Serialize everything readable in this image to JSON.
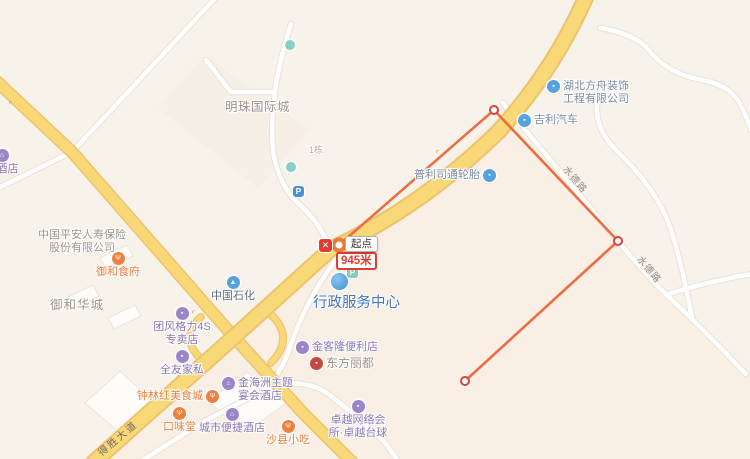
{
  "map": {
    "measurement": {
      "start_label": "起点",
      "distance": "945米",
      "delete_icon": "✕"
    },
    "road_labels": [
      {
        "name": "desheng-avenue",
        "label": "得胜大道"
      },
      {
        "name": "shuide-road-upper",
        "label": "水德路"
      },
      {
        "name": "shuide-road-lower",
        "label": "水德路"
      }
    ],
    "pois": [
      {
        "name": "hotel-left-edge",
        "lines": [
          "大酒店"
        ],
        "glyph": "⌂"
      },
      {
        "name": "mingzhu-international",
        "lines": [
          "明珠国际城"
        ]
      },
      {
        "name": "building-number",
        "lines": [
          "1栋"
        ]
      },
      {
        "name": "hubei-fangzhou-decor",
        "lines": [
          "湖北方舟装饰",
          "工程有限公司"
        ],
        "glyph": "▪"
      },
      {
        "name": "geely-auto",
        "lines": [
          "吉利汽车"
        ],
        "glyph": "▪"
      },
      {
        "name": "bridgestone-tires",
        "lines": [
          "普利司通轮胎"
        ],
        "glyph": "▪"
      },
      {
        "name": "sinopec",
        "lines": [
          "中国石化"
        ],
        "glyph": "▲"
      },
      {
        "name": "pingan-insurance",
        "lines": [
          "中国平安人寿保险",
          "股份有限公司"
        ]
      },
      {
        "name": "yuhe-restaurant",
        "lines": [
          "御和食府"
        ],
        "glyph": "Ψ"
      },
      {
        "name": "yuhe-huacheng",
        "lines": [
          "御和华城"
        ]
      },
      {
        "name": "admin-service-center",
        "lines": [
          "行政服务中心"
        ],
        "glyph": "P"
      },
      {
        "name": "tuanfeng-gree-4s",
        "lines": [
          "团风格力4S",
          "专卖店"
        ],
        "glyph": "▪"
      },
      {
        "name": "quanyou-furniture",
        "lines": [
          "全友家私"
        ],
        "glyph": "▪"
      },
      {
        "name": "jinkelong-store",
        "lines": [
          "金客隆便利店"
        ],
        "glyph": "▪"
      },
      {
        "name": "dongfang-lidu",
        "lines": [
          "东方丽都"
        ],
        "glyph": "▪"
      },
      {
        "name": "jinhaizhou-hotel",
        "lines": [
          "金海洲主题",
          "宴会酒店"
        ],
        "glyph": "⌂"
      },
      {
        "name": "zhonglinhong-food",
        "lines": [
          "钟林红美食城"
        ],
        "glyph": "Ψ"
      },
      {
        "name": "kouweitang",
        "lines": [
          "口味堂"
        ],
        "glyph": "Ψ"
      },
      {
        "name": "city-comfort-inn",
        "lines": [
          "城市便捷酒店"
        ],
        "glyph": "⌂"
      },
      {
        "name": "shaxian-snacks",
        "lines": [
          "沙县小吃"
        ],
        "glyph": "Ψ"
      },
      {
        "name": "zhuoyue-club",
        "lines": [
          "卓越网络会",
          "所·卓越台球"
        ],
        "glyph": "▪"
      },
      {
        "name": "parking",
        "glyph": "P"
      }
    ],
    "colors": {
      "bg": "#F8F3EA",
      "bg-south": "#F9EFE5",
      "block": "#F3EDE2",
      "building": "#FDFCF8",
      "building-edge": "#EAE5DA",
      "road-yellow": "#F9D878",
      "road-yellow-edge": "#EDC36E",
      "road-white": "#FFFFFF",
      "road-white-edge": "#E8E3D8",
      "measure-line": "#ED6D43",
      "measure-vertex": "#D6453C",
      "measure-start": "#F07A38",
      "delete-red": "#E23C30",
      "distance-red": "#E23C30",
      "poi-orange": "#F08040",
      "poi-purple": "#9B85C8",
      "poi-blue": "#56A2DF",
      "poi-teal": "#62C4BC",
      "poi-red": "#C34A42",
      "poi-parking": "#4A90D9",
      "poi-gov": "#3F8FD6",
      "text-orange": "#EE7D3E",
      "text-purple": "#8A77B4",
      "text-blue": "#7A8BA3",
      "text-gray": "#9B948A",
      "text-dark": "#5C6B7F",
      "text-gov": "#4077B8",
      "text-road": "#6E6A5E",
      "text-road2": "#8F8B80"
    }
  }
}
